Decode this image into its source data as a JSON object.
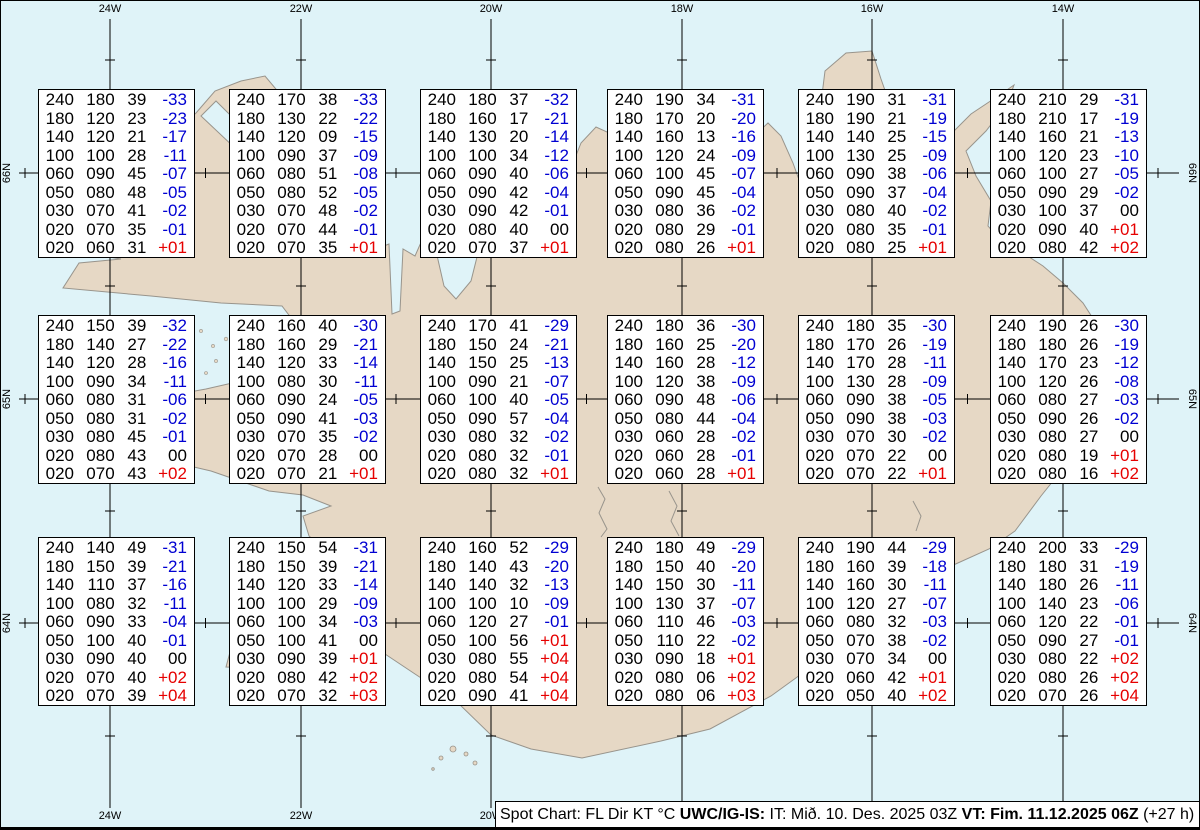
{
  "grid": {
    "lon_labels": [
      "24W",
      "22W",
      "20W",
      "18W",
      "16W",
      "14W"
    ],
    "lon_x": [
      109,
      300,
      490,
      681,
      871,
      1062
    ],
    "lat_labels": [
      "66N",
      "65N",
      "64N"
    ],
    "lat_y": [
      172,
      398,
      622
    ]
  },
  "legend_note": "Spot Chart: FL Dir KT °C",
  "caption": {
    "segments": [
      {
        "text": "Spot Chart: FL Dir KT °C ",
        "bold": false
      },
      {
        "text": "UWC/IG-IS:",
        "bold": true
      },
      {
        "text": " IT: Mið. 10. Des. 2025 03Z ",
        "bold": false
      },
      {
        "text": "VT: Fim. 11.12.2025 06Z",
        "bold": true
      },
      {
        "text": " (+27 h)",
        "bold": false
      }
    ]
  },
  "colors": {
    "water": "#dff3f8",
    "land": "#e6d8c5",
    "coastline": "#98948c",
    "temp_negative": "#0000d2",
    "temp_positive": "#e60000",
    "text": "#000000"
  },
  "spots": [
    {
      "x": 37,
      "y": 88,
      "rows": [
        [
          "240",
          "180",
          "39",
          "-33"
        ],
        [
          "180",
          "120",
          "23",
          "-23"
        ],
        [
          "140",
          "120",
          "21",
          "-17"
        ],
        [
          "100",
          "100",
          "28",
          "-11"
        ],
        [
          "060",
          "090",
          "45",
          "-07"
        ],
        [
          "050",
          "080",
          "48",
          "-05"
        ],
        [
          "030",
          "070",
          "41",
          "-02"
        ],
        [
          "020",
          "070",
          "35",
          "-01"
        ],
        [
          "020",
          "060",
          "31",
          "+01"
        ]
      ]
    },
    {
      "x": 228,
      "y": 88,
      "rows": [
        [
          "240",
          "170",
          "38",
          "-33"
        ],
        [
          "180",
          "130",
          "22",
          "-22"
        ],
        [
          "140",
          "120",
          "09",
          "-15"
        ],
        [
          "100",
          "090",
          "37",
          "-09"
        ],
        [
          "060",
          "080",
          "51",
          "-08"
        ],
        [
          "050",
          "080",
          "52",
          "-05"
        ],
        [
          "030",
          "070",
          "48",
          "-02"
        ],
        [
          "020",
          "070",
          "44",
          "-01"
        ],
        [
          "020",
          "070",
          "35",
          "+01"
        ]
      ]
    },
    {
      "x": 419,
      "y": 88,
      "rows": [
        [
          "240",
          "180",
          "37",
          "-32"
        ],
        [
          "180",
          "160",
          "17",
          "-21"
        ],
        [
          "140",
          "130",
          "20",
          "-14"
        ],
        [
          "100",
          "100",
          "34",
          "-12"
        ],
        [
          "060",
          "090",
          "40",
          "-06"
        ],
        [
          "050",
          "090",
          "42",
          "-04"
        ],
        [
          "030",
          "090",
          "42",
          "-01"
        ],
        [
          "020",
          "080",
          "40",
          "00"
        ],
        [
          "020",
          "070",
          "37",
          "+01"
        ]
      ]
    },
    {
      "x": 606,
      "y": 88,
      "rows": [
        [
          "240",
          "190",
          "34",
          "-31"
        ],
        [
          "180",
          "170",
          "20",
          "-20"
        ],
        [
          "140",
          "160",
          "13",
          "-16"
        ],
        [
          "100",
          "120",
          "24",
          "-09"
        ],
        [
          "060",
          "100",
          "45",
          "-07"
        ],
        [
          "050",
          "090",
          "45",
          "-04"
        ],
        [
          "030",
          "080",
          "36",
          "-02"
        ],
        [
          "020",
          "080",
          "29",
          "-01"
        ],
        [
          "020",
          "080",
          "26",
          "+01"
        ]
      ]
    },
    {
      "x": 797,
      "y": 88,
      "rows": [
        [
          "240",
          "190",
          "31",
          "-31"
        ],
        [
          "180",
          "190",
          "21",
          "-19"
        ],
        [
          "140",
          "140",
          "25",
          "-15"
        ],
        [
          "100",
          "130",
          "25",
          "-09"
        ],
        [
          "060",
          "090",
          "38",
          "-06"
        ],
        [
          "050",
          "090",
          "37",
          "-04"
        ],
        [
          "030",
          "080",
          "40",
          "-02"
        ],
        [
          "020",
          "080",
          "35",
          "-01"
        ],
        [
          "020",
          "080",
          "25",
          "+01"
        ]
      ]
    },
    {
      "x": 989,
      "y": 88,
      "rows": [
        [
          "240",
          "210",
          "29",
          "-31"
        ],
        [
          "180",
          "210",
          "17",
          "-19"
        ],
        [
          "140",
          "160",
          "21",
          "-13"
        ],
        [
          "100",
          "120",
          "23",
          "-10"
        ],
        [
          "060",
          "100",
          "27",
          "-05"
        ],
        [
          "050",
          "090",
          "29",
          "-02"
        ],
        [
          "030",
          "100",
          "37",
          "00"
        ],
        [
          "020",
          "090",
          "40",
          "+01"
        ],
        [
          "020",
          "080",
          "42",
          "+02"
        ]
      ]
    },
    {
      "x": 37,
      "y": 314,
      "rows": [
        [
          "240",
          "150",
          "39",
          "-32"
        ],
        [
          "180",
          "140",
          "27",
          "-22"
        ],
        [
          "140",
          "120",
          "28",
          "-16"
        ],
        [
          "100",
          "090",
          "34",
          "-11"
        ],
        [
          "060",
          "080",
          "31",
          "-06"
        ],
        [
          "050",
          "080",
          "31",
          "-02"
        ],
        [
          "030",
          "080",
          "45",
          "-01"
        ],
        [
          "020",
          "080",
          "43",
          "00"
        ],
        [
          "020",
          "070",
          "43",
          "+02"
        ]
      ]
    },
    {
      "x": 228,
      "y": 314,
      "rows": [
        [
          "240",
          "160",
          "40",
          "-30"
        ],
        [
          "180",
          "160",
          "29",
          "-21"
        ],
        [
          "140",
          "120",
          "33",
          "-14"
        ],
        [
          "100",
          "080",
          "30",
          "-11"
        ],
        [
          "060",
          "090",
          "24",
          "-05"
        ],
        [
          "050",
          "090",
          "41",
          "-03"
        ],
        [
          "030",
          "070",
          "35",
          "-02"
        ],
        [
          "020",
          "070",
          "28",
          "00"
        ],
        [
          "020",
          "070",
          "21",
          "+01"
        ]
      ]
    },
    {
      "x": 419,
      "y": 314,
      "rows": [
        [
          "240",
          "170",
          "41",
          "-29"
        ],
        [
          "180",
          "150",
          "24",
          "-21"
        ],
        [
          "140",
          "150",
          "25",
          "-13"
        ],
        [
          "100",
          "090",
          "21",
          "-07"
        ],
        [
          "060",
          "100",
          "40",
          "-05"
        ],
        [
          "050",
          "090",
          "57",
          "-04"
        ],
        [
          "030",
          "080",
          "32",
          "-02"
        ],
        [
          "020",
          "080",
          "32",
          "-01"
        ],
        [
          "020",
          "080",
          "32",
          "+01"
        ]
      ]
    },
    {
      "x": 606,
      "y": 314,
      "rows": [
        [
          "240",
          "180",
          "36",
          "-30"
        ],
        [
          "180",
          "160",
          "25",
          "-20"
        ],
        [
          "140",
          "160",
          "28",
          "-12"
        ],
        [
          "100",
          "120",
          "38",
          "-09"
        ],
        [
          "060",
          "090",
          "48",
          "-06"
        ],
        [
          "050",
          "080",
          "44",
          "-04"
        ],
        [
          "030",
          "060",
          "28",
          "-02"
        ],
        [
          "020",
          "060",
          "28",
          "-01"
        ],
        [
          "020",
          "060",
          "28",
          "+01"
        ]
      ]
    },
    {
      "x": 797,
      "y": 314,
      "rows": [
        [
          "240",
          "180",
          "35",
          "-30"
        ],
        [
          "180",
          "170",
          "26",
          "-19"
        ],
        [
          "140",
          "170",
          "28",
          "-11"
        ],
        [
          "100",
          "130",
          "28",
          "-09"
        ],
        [
          "060",
          "090",
          "38",
          "-05"
        ],
        [
          "050",
          "090",
          "38",
          "-03"
        ],
        [
          "030",
          "070",
          "30",
          "-02"
        ],
        [
          "020",
          "070",
          "22",
          "00"
        ],
        [
          "020",
          "070",
          "22",
          "+01"
        ]
      ]
    },
    {
      "x": 989,
      "y": 314,
      "rows": [
        [
          "240",
          "190",
          "26",
          "-30"
        ],
        [
          "180",
          "180",
          "26",
          "-19"
        ],
        [
          "140",
          "170",
          "23",
          "-12"
        ],
        [
          "100",
          "120",
          "26",
          "-08"
        ],
        [
          "060",
          "080",
          "27",
          "-03"
        ],
        [
          "050",
          "090",
          "26",
          "-02"
        ],
        [
          "030",
          "080",
          "27",
          "00"
        ],
        [
          "020",
          "080",
          "19",
          "+01"
        ],
        [
          "020",
          "080",
          "16",
          "+02"
        ]
      ]
    },
    {
      "x": 37,
      "y": 536,
      "rows": [
        [
          "240",
          "140",
          "49",
          "-31"
        ],
        [
          "180",
          "150",
          "39",
          "-21"
        ],
        [
          "140",
          "110",
          "37",
          "-16"
        ],
        [
          "100",
          "080",
          "32",
          "-11"
        ],
        [
          "060",
          "090",
          "33",
          "-04"
        ],
        [
          "050",
          "100",
          "40",
          "-01"
        ],
        [
          "030",
          "090",
          "40",
          "00"
        ],
        [
          "020",
          "070",
          "40",
          "+02"
        ],
        [
          "020",
          "070",
          "39",
          "+04"
        ]
      ]
    },
    {
      "x": 228,
      "y": 536,
      "rows": [
        [
          "240",
          "150",
          "54",
          "-31"
        ],
        [
          "180",
          "150",
          "39",
          "-21"
        ],
        [
          "140",
          "120",
          "33",
          "-14"
        ],
        [
          "100",
          "100",
          "29",
          "-09"
        ],
        [
          "060",
          "100",
          "34",
          "-03"
        ],
        [
          "050",
          "100",
          "41",
          "00"
        ],
        [
          "030",
          "090",
          "39",
          "+01"
        ],
        [
          "020",
          "080",
          "42",
          "+02"
        ],
        [
          "020",
          "070",
          "32",
          "+03"
        ]
      ]
    },
    {
      "x": 419,
      "y": 536,
      "rows": [
        [
          "240",
          "160",
          "52",
          "-29"
        ],
        [
          "180",
          "140",
          "43",
          "-20"
        ],
        [
          "140",
          "140",
          "32",
          "-13"
        ],
        [
          "100",
          "100",
          "10",
          "-09"
        ],
        [
          "060",
          "120",
          "27",
          "-01"
        ],
        [
          "050",
          "100",
          "56",
          "+01"
        ],
        [
          "030",
          "080",
          "55",
          "+04"
        ],
        [
          "020",
          "080",
          "54",
          "+04"
        ],
        [
          "020",
          "090",
          "41",
          "+04"
        ]
      ]
    },
    {
      "x": 606,
      "y": 536,
      "rows": [
        [
          "240",
          "180",
          "49",
          "-29"
        ],
        [
          "180",
          "150",
          "40",
          "-20"
        ],
        [
          "140",
          "150",
          "30",
          "-11"
        ],
        [
          "100",
          "130",
          "37",
          "-07"
        ],
        [
          "060",
          "110",
          "46",
          "-03"
        ],
        [
          "050",
          "110",
          "22",
          "-02"
        ],
        [
          "030",
          "090",
          "18",
          "+01"
        ],
        [
          "020",
          "080",
          "06",
          "+02"
        ],
        [
          "020",
          "080",
          "06",
          "+03"
        ]
      ]
    },
    {
      "x": 797,
      "y": 536,
      "rows": [
        [
          "240",
          "190",
          "44",
          "-29"
        ],
        [
          "180",
          "160",
          "39",
          "-18"
        ],
        [
          "140",
          "160",
          "30",
          "-11"
        ],
        [
          "100",
          "120",
          "27",
          "-07"
        ],
        [
          "060",
          "080",
          "32",
          "-03"
        ],
        [
          "050",
          "070",
          "38",
          "-02"
        ],
        [
          "030",
          "070",
          "34",
          "00"
        ],
        [
          "020",
          "060",
          "42",
          "+01"
        ],
        [
          "020",
          "050",
          "40",
          "+02"
        ]
      ]
    },
    {
      "x": 989,
      "y": 536,
      "rows": [
        [
          "240",
          "200",
          "33",
          "-29"
        ],
        [
          "180",
          "180",
          "31",
          "-19"
        ],
        [
          "140",
          "180",
          "26",
          "-11"
        ],
        [
          "100",
          "140",
          "23",
          "-06"
        ],
        [
          "060",
          "120",
          "22",
          "-01"
        ],
        [
          "050",
          "090",
          "27",
          "-01"
        ],
        [
          "030",
          "080",
          "22",
          "+02"
        ],
        [
          "020",
          "080",
          "26",
          "+02"
        ],
        [
          "020",
          "070",
          "26",
          "+04"
        ]
      ]
    }
  ]
}
